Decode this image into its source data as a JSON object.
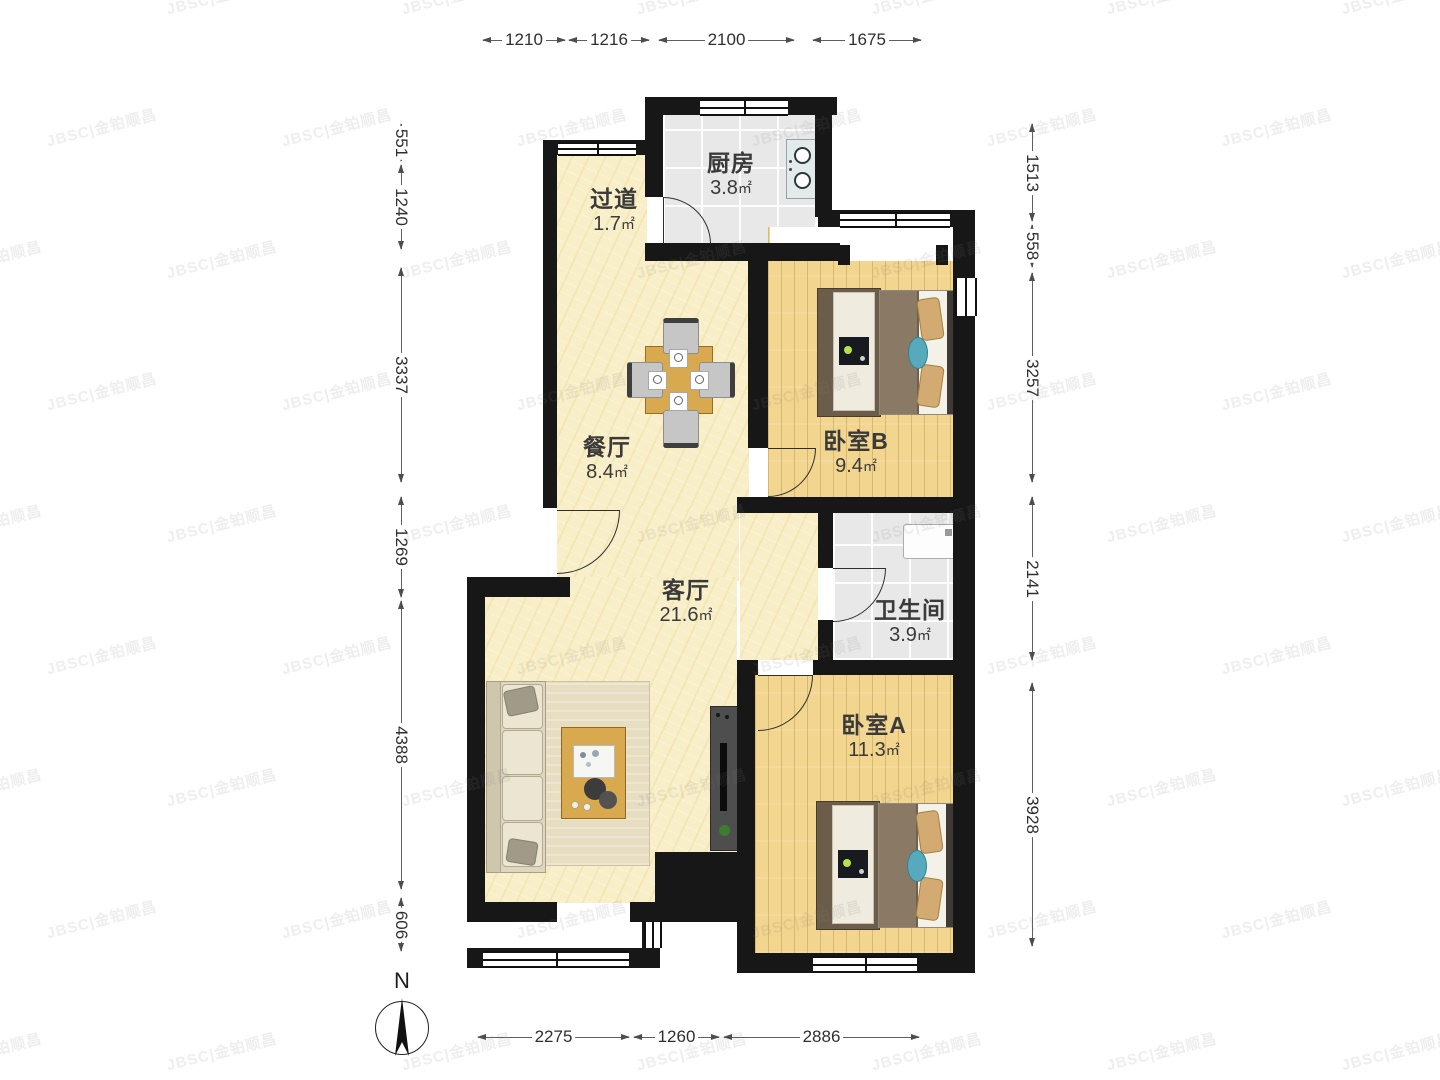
{
  "watermark": {
    "text": "JBSC|金铂顺昌"
  },
  "compass": {
    "label": "N"
  },
  "area_unit": "㎡",
  "rooms": [
    {
      "id": "kitchen",
      "name": "厨房",
      "area": "3.8",
      "cx": 731,
      "top": 150
    },
    {
      "id": "hallway",
      "name": "过道",
      "area": "1.7",
      "cx": 614,
      "top": 186
    },
    {
      "id": "dining",
      "name": "餐厅",
      "area": "8.4",
      "cx": 607,
      "top": 434
    },
    {
      "id": "bedroom-b",
      "name": "卧室B",
      "area": "9.4",
      "cx": 856,
      "top": 428
    },
    {
      "id": "living",
      "name": "客厅",
      "area": "21.6",
      "cx": 686,
      "top": 577
    },
    {
      "id": "bathroom",
      "name": "卫生间",
      "area": "3.9",
      "cx": 910,
      "top": 597
    },
    {
      "id": "bedroom-a",
      "name": "卧室A",
      "area": "11.3",
      "cx": 874,
      "top": 712
    }
  ],
  "dimensions": {
    "top": {
      "axis": 40,
      "segments": [
        {
          "label": "1210",
          "from": 482,
          "to": 566
        },
        {
          "label": "1216",
          "from": 568,
          "to": 650
        },
        {
          "label": "2100",
          "from": 658,
          "to": 795
        },
        {
          "label": "1675",
          "from": 812,
          "to": 922
        }
      ]
    },
    "bottom": {
      "axis": 1037,
      "segments": [
        {
          "label": "2275",
          "from": 477,
          "to": 630
        },
        {
          "label": "1260",
          "from": 633,
          "to": 720
        },
        {
          "label": "2886",
          "from": 723,
          "to": 920
        }
      ]
    },
    "left": {
      "axis": 401,
      "segments": [
        {
          "label": "551",
          "from": 123,
          "to": 162
        },
        {
          "label": "1240",
          "from": 164,
          "to": 250
        },
        {
          "label": "3337",
          "from": 267,
          "to": 483
        },
        {
          "label": "1269",
          "from": 496,
          "to": 598
        },
        {
          "label": "4388",
          "from": 600,
          "to": 890
        },
        {
          "label": "606",
          "from": 897,
          "to": 952
        }
      ]
    },
    "right": {
      "axis": 1032,
      "segments": [
        {
          "label": "1513",
          "from": 123,
          "to": 222
        },
        {
          "label": "558",
          "from": 224,
          "to": 268
        },
        {
          "label": "3257",
          "from": 272,
          "to": 483
        },
        {
          "label": "2141",
          "from": 496,
          "to": 661
        },
        {
          "label": "3928",
          "from": 682,
          "to": 947
        }
      ]
    }
  },
  "colors": {
    "wall": "#171717",
    "floor_living": "#f8efc9",
    "floor_bedroom": "#f2d58e",
    "floor_tile": "#e8e8e8",
    "accent_teal": "#57aabc",
    "dimension_text": "#2f2f2f"
  }
}
